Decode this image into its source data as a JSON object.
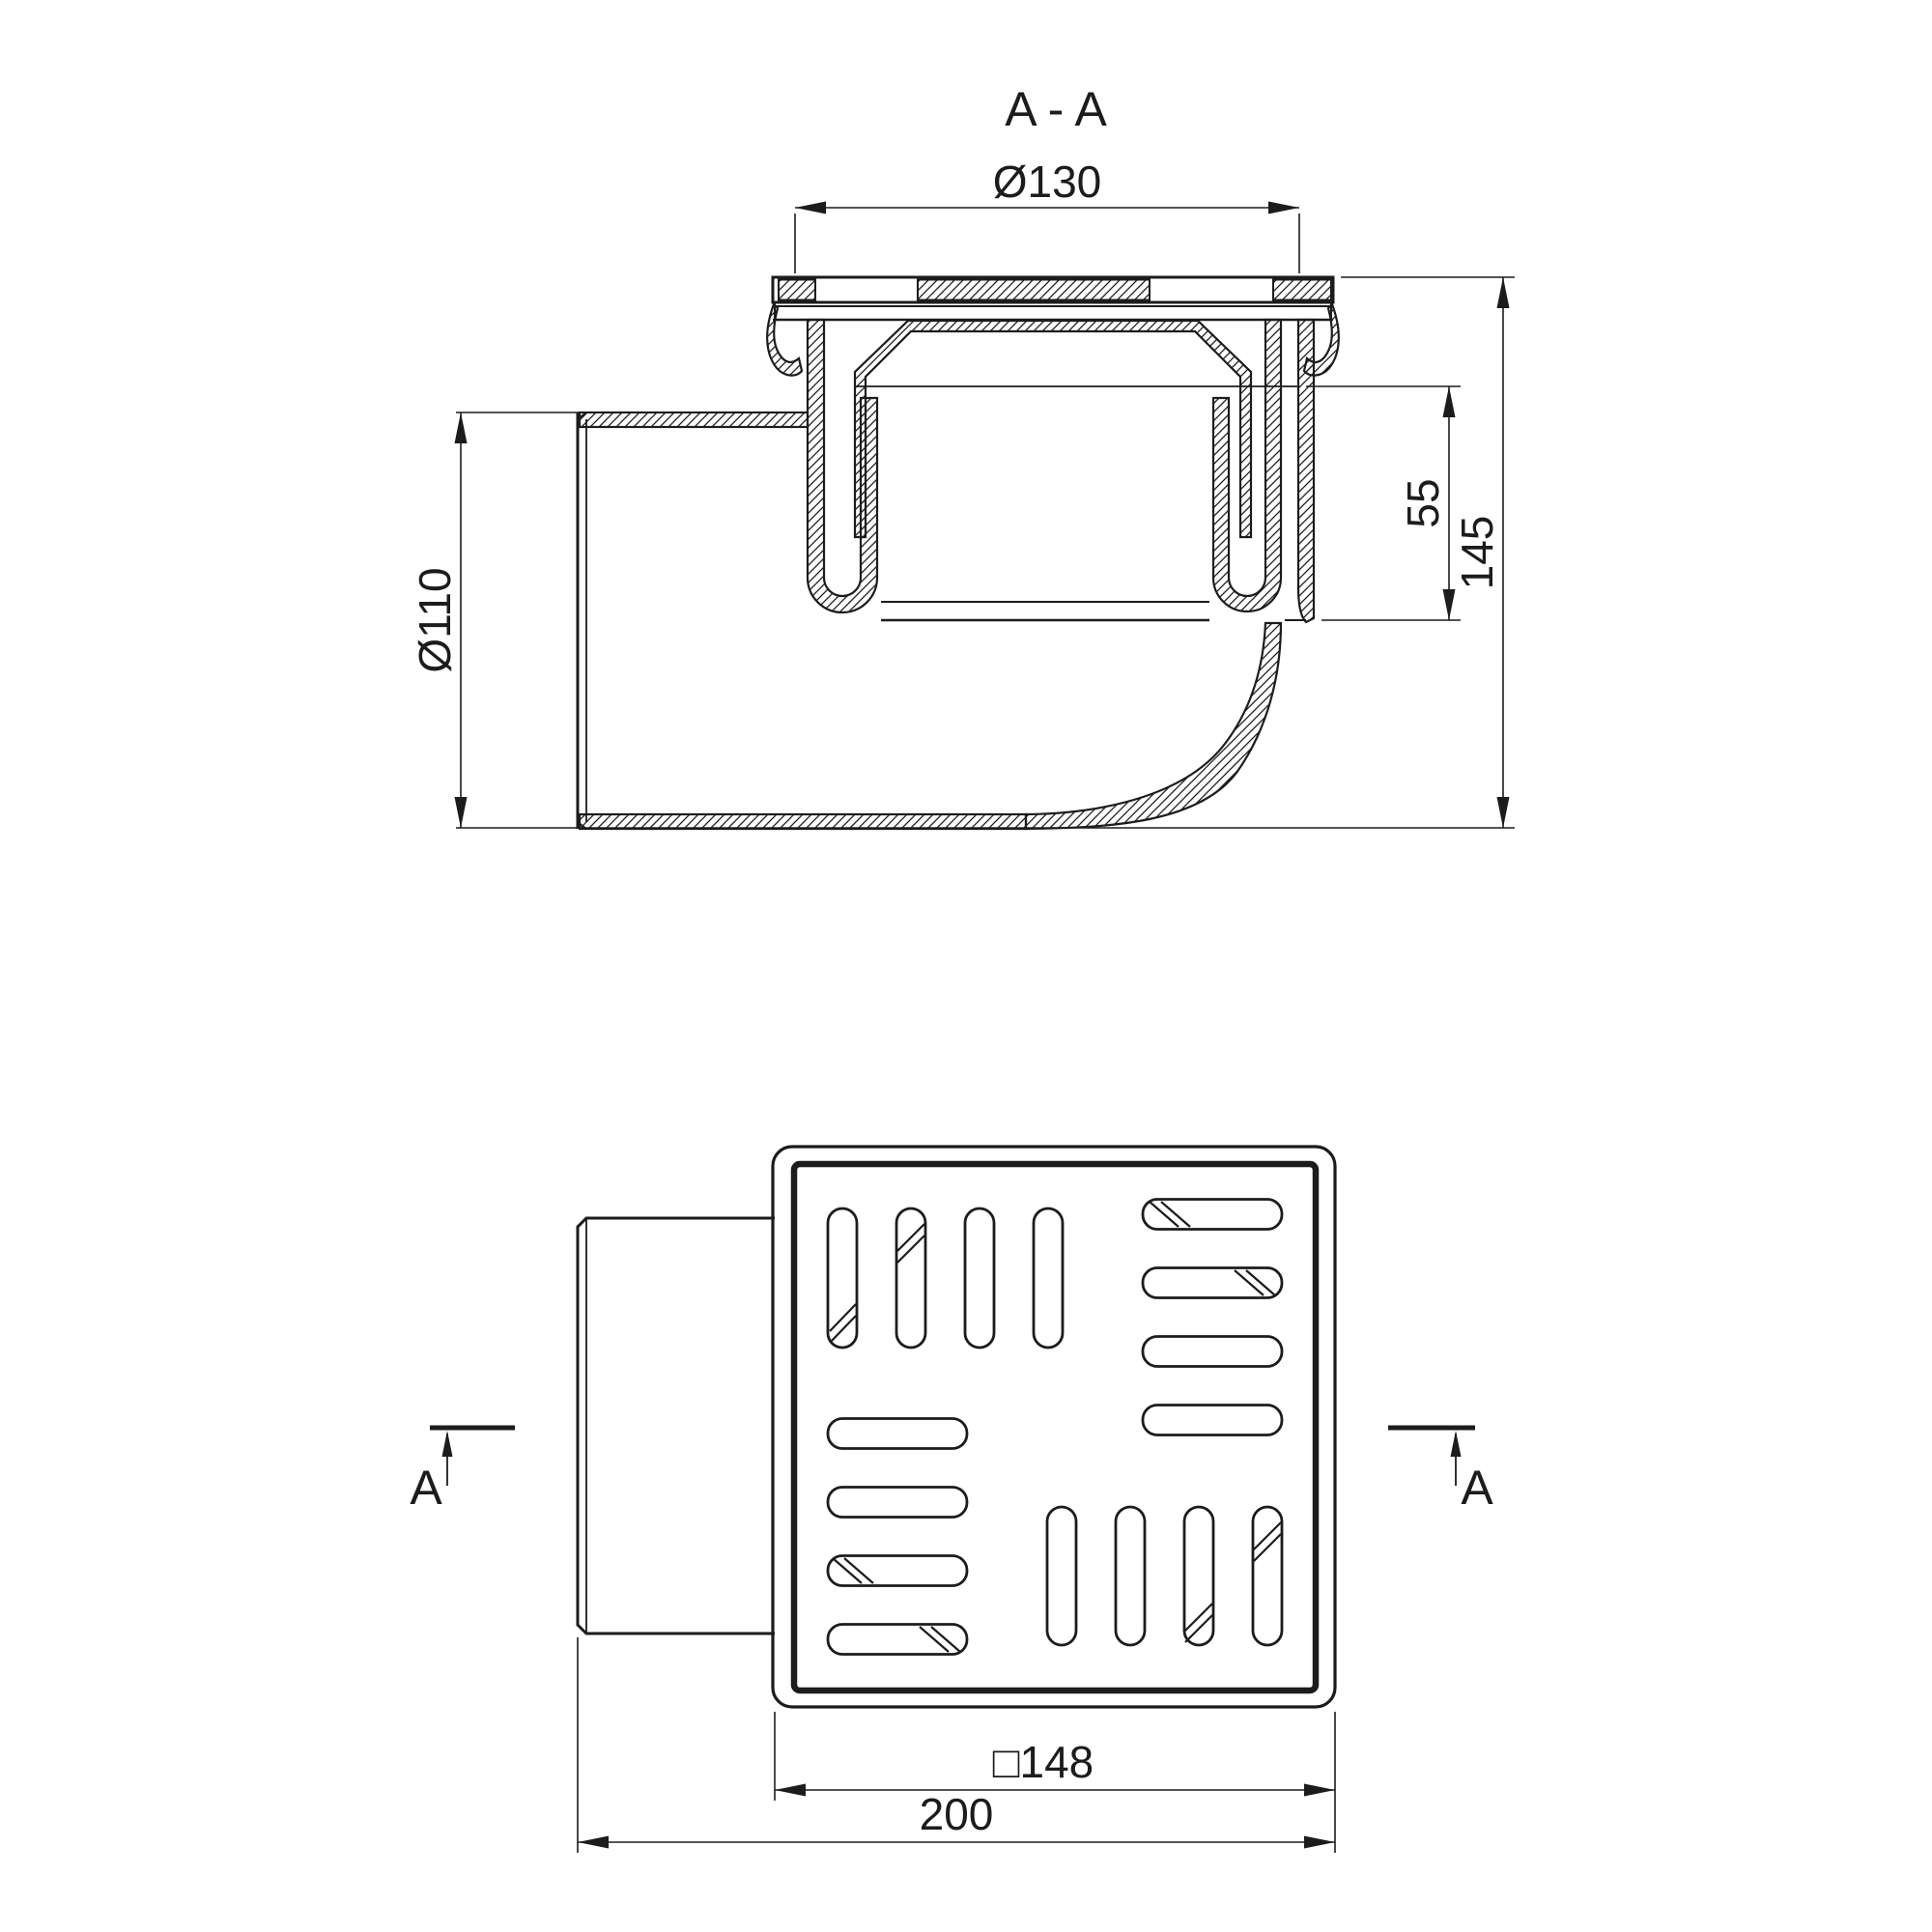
{
  "drawing": {
    "section": {
      "title": "A - A",
      "dim_top_diameter": "Ø130",
      "dim_pipe_diameter": "Ø110",
      "dim_trap_depth": "55",
      "dim_total_height": "145"
    },
    "plan": {
      "dim_grate_square": "□148",
      "dim_total_length": "200",
      "cut_label_left": "A",
      "cut_label_right": "A"
    },
    "colors": {
      "ink": "#1c1c1c",
      "paper": "#ffffff"
    }
  }
}
